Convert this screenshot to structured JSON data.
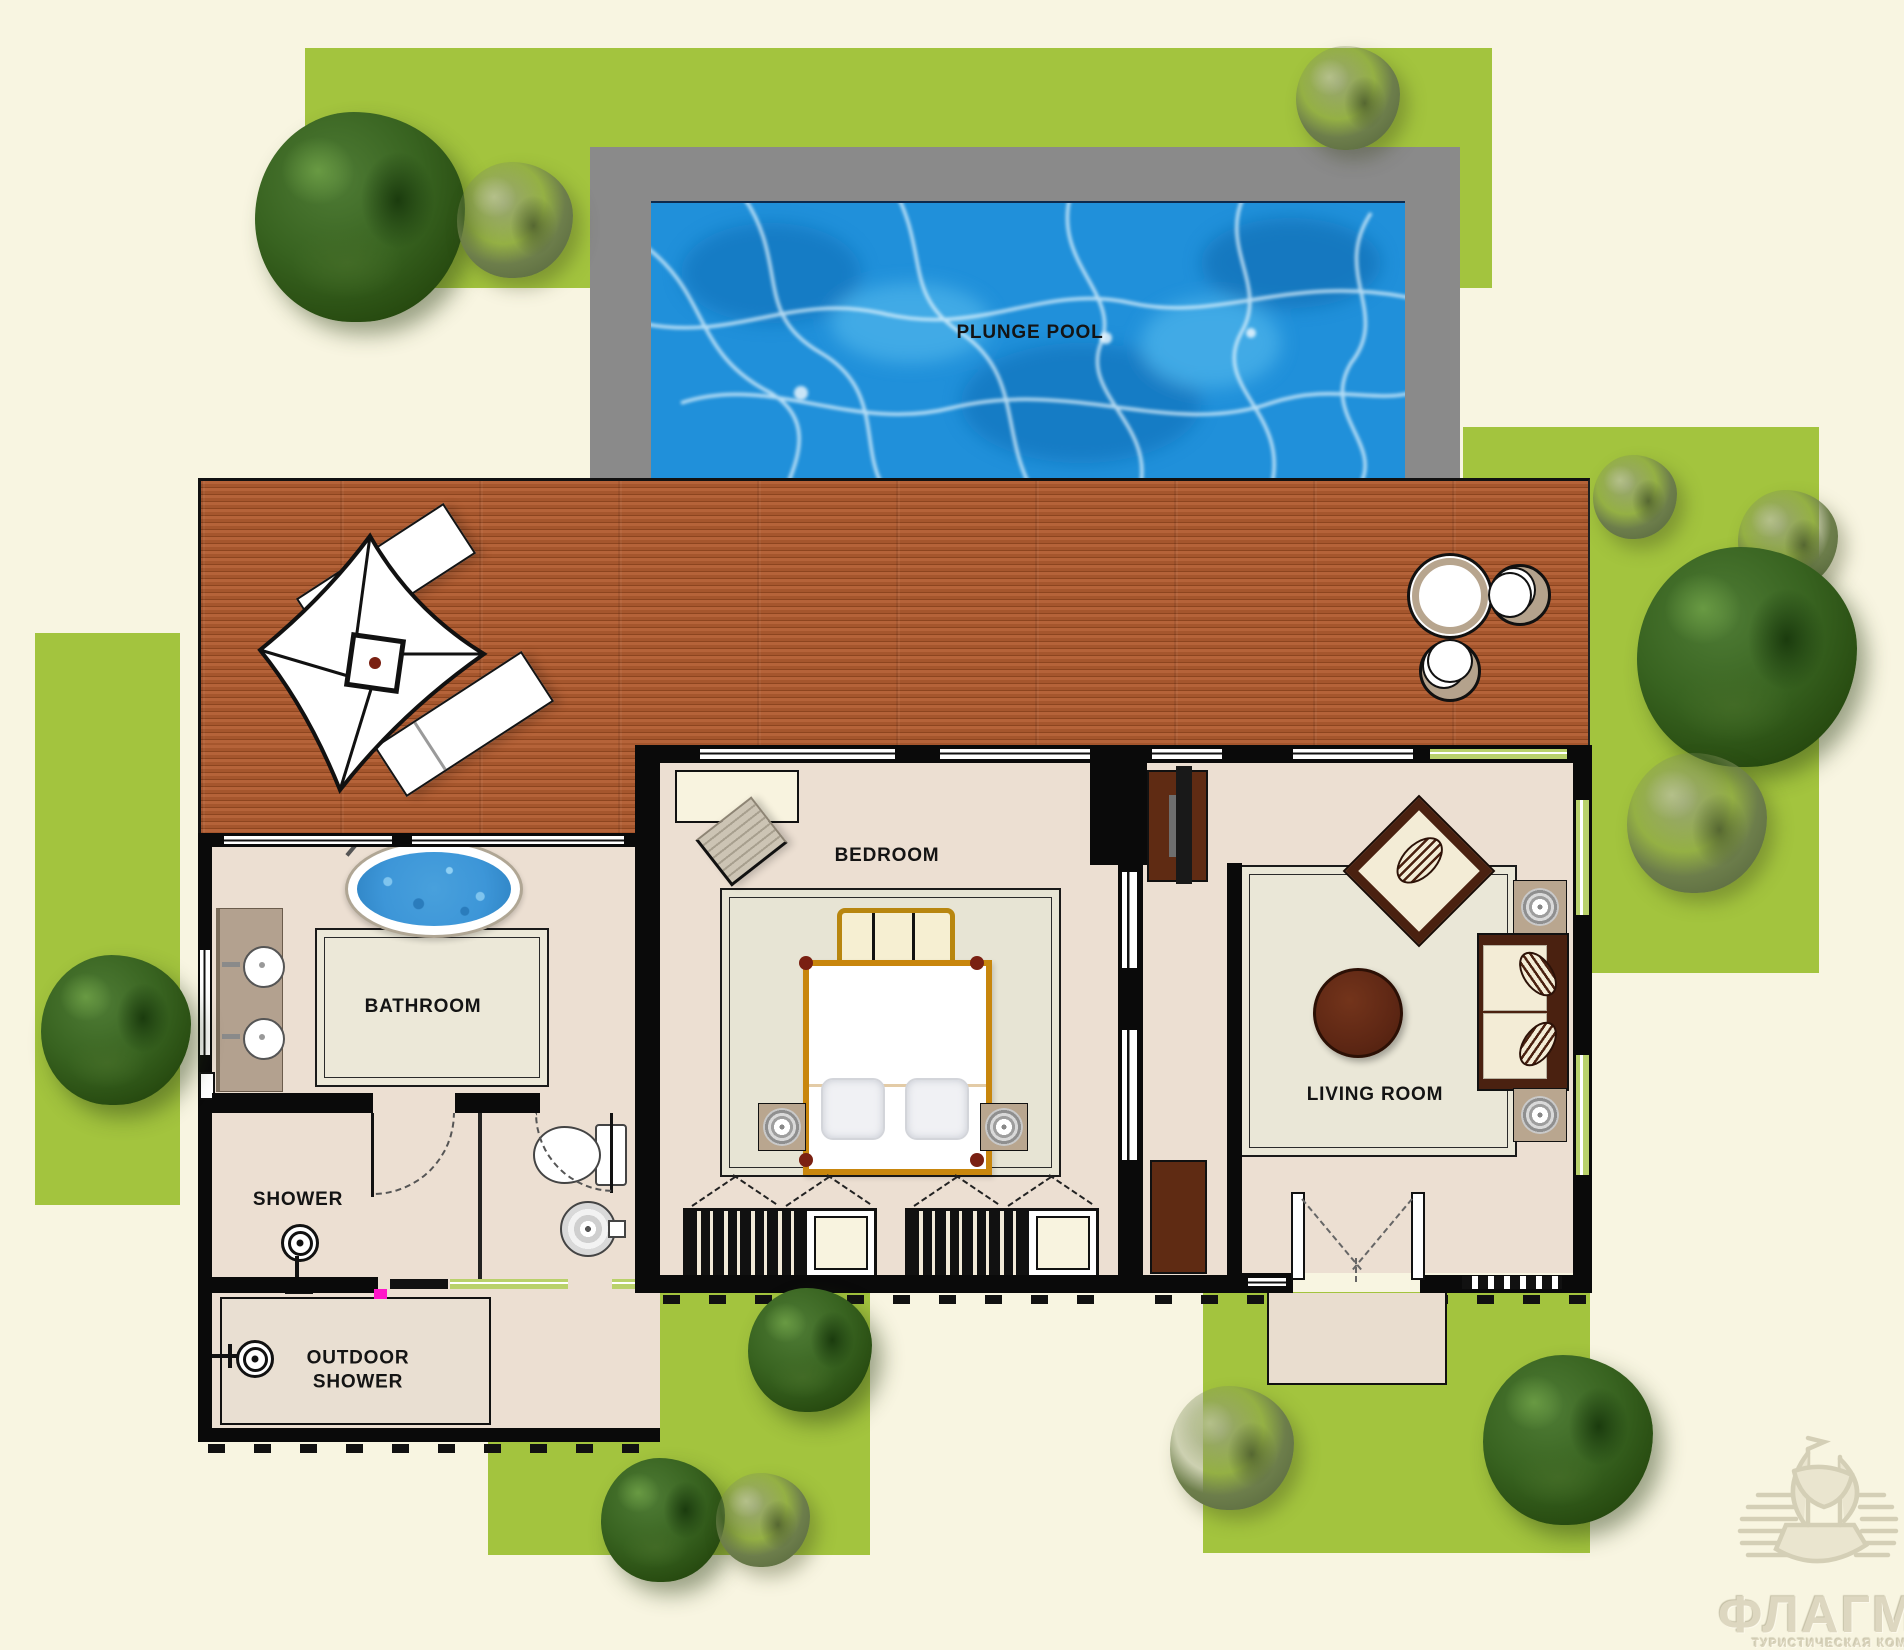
{
  "labels": {
    "plunge_pool": "PLUNGE POOL",
    "bedroom": "BEDROOM",
    "bathroom": "BATHROOM",
    "shower": "SHOWER",
    "outdoor_shower": "OUTDOOR\nSHOWER",
    "living_room": "LIVING ROOM"
  },
  "watermark": {
    "brand": "ФЛАГМАН",
    "tagline": "ТУРИСТИЧЕСКАЯ КОМПАНИЯ"
  },
  "colors": {
    "background": "#f8f5e1",
    "grass": "#a3c43e",
    "pool_water": "#2090da",
    "pool_surround": "#8a8a8a",
    "deck_wood": "#a85a30",
    "wall": "#0a0a0a",
    "floor": "#ecdfd2",
    "bed_frame": "#c8860d",
    "furniture_brown": "#5f2b13",
    "marker_magenta": "#ff14c8"
  }
}
